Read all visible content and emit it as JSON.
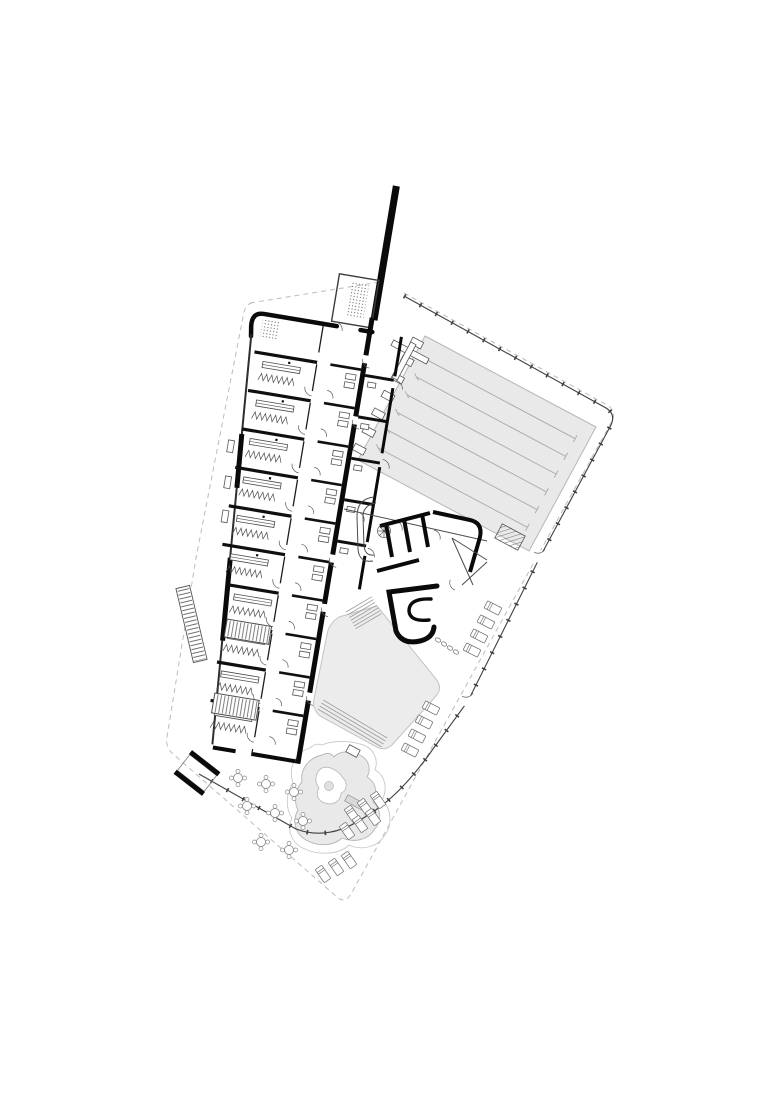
{
  "canvas": {
    "width": 780,
    "height": 1103,
    "background": "#ffffff"
  },
  "colors": {
    "wall": "#0a0a0a",
    "partition": "#141414",
    "thin_line": "#4c4c4c",
    "light_line": "#9b9b9b",
    "water_fill": "#e9e9e9",
    "water_edge": "#b6b6b6",
    "deck_fill": "#ececec",
    "deck_edge": "#c3c3c3",
    "lane_line": "#a9a9a9",
    "boundary": "#3f3f3f",
    "property_dash": "#bcbcbc",
    "fixture": "#555555",
    "island_fill": "#ffffff"
  },
  "plan": {
    "type": "architectural-site-plan-aquatic-center",
    "lap_pool": {
      "lane_dividers": 6,
      "swim_lanes": 7,
      "starting_blocks": 7
    },
    "pentagon_deck": {
      "sides": 5,
      "step_flights": 2
    },
    "leisure_pool": {
      "islands": 1,
      "slide_bridges": 1
    },
    "changing_room_modules": 10,
    "service_room_modules": 10,
    "upper_hall_rooms": 5,
    "sunbed_clusters": 4,
    "sunbeds_total": 17,
    "terrace_tables": 8,
    "stair_flights": 4,
    "spiral_stairs": 1
  }
}
